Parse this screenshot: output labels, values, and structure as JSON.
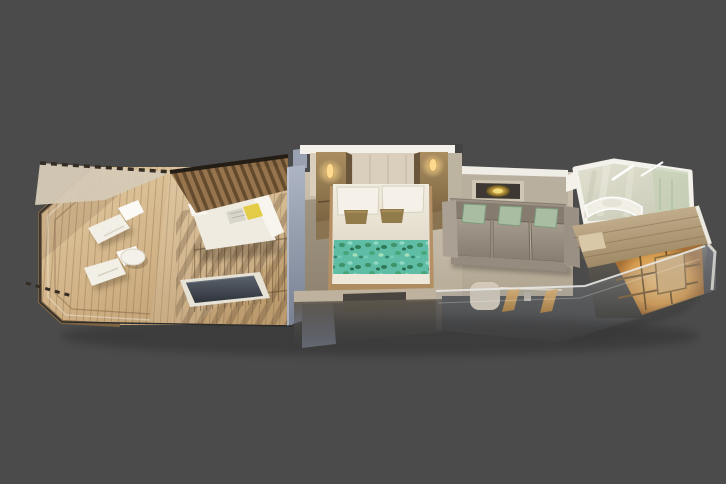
{
  "meta": {
    "description": "3D cutaway rendering of a cruise-ship veranda suite floor plan on a dark gray background",
    "background_color": "#4b4b4b",
    "view": "isometric top-down cutaway, suite laid out horizontally"
  },
  "palette": {
    "background": "#4b4b4b",
    "deck_wood": "#d2b488",
    "deck_wood_shadow": "#a58457",
    "canopy": "#d5cab6",
    "pergola_slats": "#8a6a46",
    "daybed_white": "#efebe0",
    "pillow_yellow": "#e3cc48",
    "pillow_gray": "#d8d5cb",
    "pool_water": "#3c4149",
    "pool_frame": "#e7e2d6",
    "divider_wall_blue_gray": "#97a0b0",
    "carpet": "#c6bbaa",
    "white_trim": "#f3f1ea",
    "headboard_cream": "#d9cfbc",
    "wood_tower": "#9a8157",
    "sconce_glow": "#ffd98e",
    "bed_linen": "#efe9dd",
    "accent_pillow_bronze": "#937c4c",
    "blanket_teal": "#5fbda6",
    "blanket_leaf_green": "#3e9468",
    "sofa_taupe": "#9a9083",
    "sofa_pillow_green": "#a8bda2",
    "artwork_gold": "#e6c04a",
    "bathroom_marble": "#d6d3c0",
    "bathroom_glass_green": "#b5c4a2",
    "corridor_ceiling_wood": "#c0ab89",
    "wardrobe_glow_orange": "#e0a95e",
    "entry_floor_dark": "#58544c",
    "glass_front_wall": "#aab4c3"
  },
  "rooms": [
    {
      "id": "veranda",
      "label": "Open veranda deck with two lounge chairs and round side table"
    },
    {
      "id": "cabana",
      "label": "Covered cabana with pergola roof, daybed and plunge pool"
    },
    {
      "id": "bedroom",
      "label": "Bedroom with king bed, lit sconce towers and teal patterned blanket"
    },
    {
      "id": "living",
      "label": "Sitting area with three-seat sofa, wall artwork, desk and chair"
    },
    {
      "id": "bathroom",
      "label": "Marble bathroom with curved vanity and mirror lights"
    },
    {
      "id": "entry",
      "label": "Entry hall with glowing wardrobe shelves and cabin door"
    }
  ],
  "furniture": {
    "veranda": [
      "lounge-chair",
      "lounge-chair",
      "round-table"
    ],
    "cabana": [
      "pergola-roof",
      "daybed",
      "plunge-pool",
      "railing"
    ],
    "bedroom": [
      "king-bed",
      "pillows",
      "accent-pillows",
      "teal-blanket",
      "nightstand-tower-left",
      "nightstand-tower-right",
      "wall-sconces"
    ],
    "living": [
      "sofa",
      "green-pillows",
      "artwork",
      "desk",
      "chair"
    ],
    "bathroom": [
      "curved-vanity",
      "light-strips",
      "glass-walls"
    ],
    "entry": [
      "wardrobe-shelves",
      "cabin-door",
      "transparent-front-wall"
    ]
  }
}
